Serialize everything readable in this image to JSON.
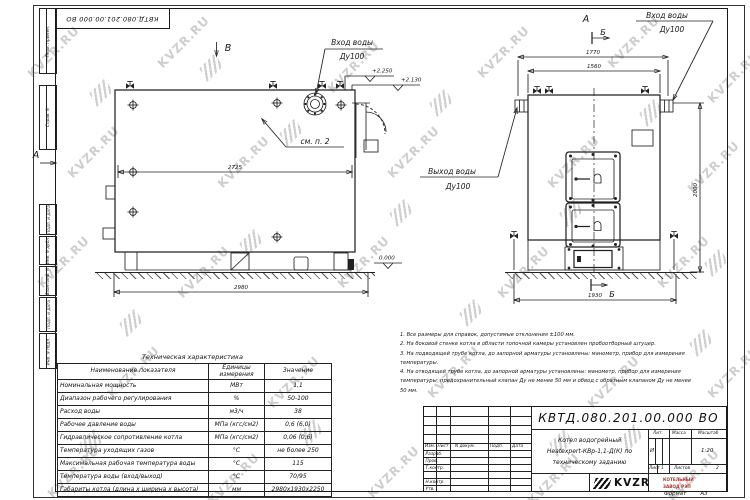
{
  "sheet": {
    "designation": "КВТД.080.201.00.000  ВО",
    "format_label": "Формат",
    "format_value": "А3"
  },
  "watermark": {
    "text": "KVZR.RU"
  },
  "frame_columns": {
    "col1": "Перв. примен.",
    "col2": "Справ. N",
    "col3": "Подп. и дата",
    "col4": "Инв. N дубл.",
    "col5": "Взам. инв. N",
    "col6": "Подп. и дата",
    "col7": "Инв. N подл."
  },
  "views": {
    "left": {
      "label_b": "В",
      "label_a": "А",
      "inlet_line1": "Вход воды",
      "inlet_line2": "Ду100",
      "see_note": "см. п. 2",
      "dim_inner": "2725",
      "dim_overall": "2980",
      "elev_top1": "+2.250",
      "elev_top2": "+2.130",
      "elev_zero": "0.000"
    },
    "right": {
      "label_a": "А",
      "label_b_top": "Б",
      "label_b_bottom": "Б",
      "inlet_line1": "Вход воды",
      "inlet_line2": "Ду100",
      "outlet_line1": "Выход воды",
      "outlet_line2": "Ду100",
      "dim_top_outer": "1770",
      "dim_top_inner": "1560",
      "dim_height": "2000",
      "dim_bottom": "1930"
    }
  },
  "notes": {
    "lines": [
      "1. Все размеры для справок, допустимые отклонения ±100 мм.",
      "2. На боковой стенке котла в области топочной камеры установлен пробоотборный штуцер.",
      "3. На подводящей трубе котла, до запорной арматуры установлены: манометр, прибор для измерения",
      "температуры.",
      "4. На отводящей трубе котла, до запорной арматуры установлены: манометр, прибор для измерения",
      "температуры; предохранительный клапан Ду не менее 50 мм и обвод с обратным клапаном Ду не менее",
      "50 мм."
    ]
  },
  "tech_table": {
    "title": "Техническая характеристика",
    "headers": [
      "Наименование показателя",
      "Единицы измерения",
      "Значение"
    ],
    "rows": [
      [
        "Номинальная мощность",
        "МВт",
        "1,1"
      ],
      [
        "Диапазон рабочего регулирования",
        "%",
        "50-100"
      ],
      [
        "Расход воды",
        "м3/ч",
        "38"
      ],
      [
        "Рабочее давление воды",
        "МПа (кгс/см2)",
        "0,6 (6,0)"
      ],
      [
        "Гидравлическое сопротивление котла",
        "МПа (кгс/см2)",
        "0,06 (0,6)"
      ],
      [
        "Температура уходящих газов",
        "°С",
        "не более 250"
      ],
      [
        "Максимальная рабочая температура воды",
        "°С",
        "115"
      ],
      [
        "Температура воды (вход/выход)",
        "°С",
        "70/95"
      ],
      [
        "Габариты котла (длина х ширина х высота)",
        "мм",
        "2980х1930х2250"
      ]
    ]
  },
  "title_block": {
    "designation": "КВТД.080.201.00.000  ВО",
    "doc_name_lines": [
      "Котел водогрейный",
      "Heatexpert-КВр-1,1-Д(К) по",
      "техническому заданию"
    ],
    "header_cells": [
      "Изм.",
      "Лист",
      "N докум.",
      "Подп.",
      "Дата"
    ],
    "row_labels": [
      "Разраб.",
      "Пров.",
      "Т.контр.",
      "Н.контр.",
      "Утв."
    ],
    "lit_label": "Лит.",
    "lit_value": "И",
    "mass_label": "Масса",
    "scale_label": "Масштаб",
    "scale_value": "1:20",
    "sheet_label": "Лист",
    "sheet_value": "1",
    "sheets_label": "Листов",
    "sheets_value": "2",
    "company_logo": "KVZR",
    "company_line1": "КОТЕЛЬНЫЙ",
    "company_line2": "ЗАВОД РЭП"
  }
}
